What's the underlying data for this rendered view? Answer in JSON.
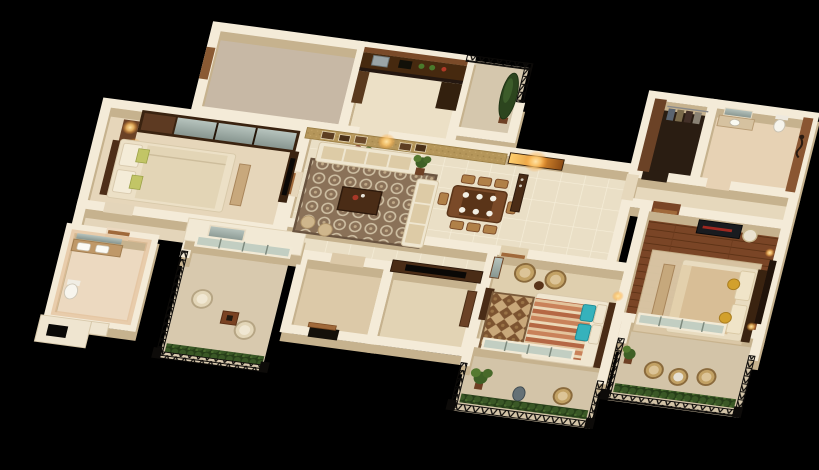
{
  "scene": {
    "title": "3D isometric floor plan render of a 3-bedroom apartment on a black background",
    "projection": "isometric 3D cutaway floor plan",
    "background_color": "#000000",
    "palette": {
      "wall_top": "#f4ebd8",
      "wall_side": "#c6b28e",
      "floor_tile": "#eadfc6",
      "accent_wall_gold": "#b5965a",
      "dark_wood": "#4a2c16",
      "mid_wood": "#8a5a33",
      "wood_floor": "#7a4526",
      "rug_brown": "#8a7158",
      "railing_iron": "#0d0b09",
      "plant_green": "#3f6026",
      "lamp_glow": "#ffd27f",
      "teal_pillow": "#36b2bc",
      "striped_bedding": "#c9825a",
      "bath_peach": "#e2bf98"
    },
    "rooms": [
      {
        "id": "store-room",
        "label": "Store / terrace room with bare taupe floor",
        "floor_color": "#c7b8a5",
        "furniture": []
      },
      {
        "id": "kitchen",
        "label": "Kitchen with dark wood cabinets and black countertop",
        "floor_color": "#ece0c6",
        "furniture": [
          "wall cabinets",
          "steel sink",
          "hob",
          "counter plants",
          "tall unit"
        ]
      },
      {
        "id": "service-balcony",
        "label": "Service balcony with iron railing and tall cypress plant",
        "floor_color": "#d5c7ad",
        "furniture": [
          "iron railing",
          "cypress plant"
        ]
      },
      {
        "id": "walk-in-closet",
        "label": "Walk-in closet with hanging clothes",
        "floor_color": "#2a1d12",
        "furniture": [
          "wood cabinet",
          "clothes rail"
        ]
      },
      {
        "id": "master-bathroom",
        "label": "Master bathroom with vanity, toilet and shower on brown wall",
        "floor_color": "#e7d2b4",
        "furniture": [
          "mirror",
          "vanity basin",
          "toilet",
          "shower fixture"
        ]
      },
      {
        "id": "suite-corridor",
        "label": "Corridor to master suite",
        "floor_color": "#e6d8bc",
        "furniture": []
      },
      {
        "id": "bedroom-1",
        "label": "Bedroom with mirrored wardrobe and lit bedside lamps",
        "floor_color": "#e6d6ba",
        "furniture": [
          "mirrored sliding wardrobe",
          "double bed with cream bedding",
          "green accent pillows",
          "corner dresser with lamps",
          "foot bench",
          "TV unit"
        ]
      },
      {
        "id": "inner-lobby",
        "label": "Inner lobby passage",
        "floor_color": "#e4d5ba",
        "furniture": []
      },
      {
        "id": "common-bathroom",
        "label": "Common bathroom with twin basin vanity and toilet",
        "floor_color": "#ecd9c0",
        "furniture": [
          "mirror",
          "twin basins",
          "toilet"
        ]
      },
      {
        "id": "living-room",
        "label": "Living room with gold accent wall, patterned rug and cream L-sofa",
        "floor_color": "#eadfc6",
        "furniture": [
          "gold textured accent wall with framed pictures and wall lamp",
          "patterned brown rug",
          "L-shaped cream sofa",
          "dark wood coffee table",
          "bonsai plant",
          "poufs"
        ]
      },
      {
        "id": "dining-area",
        "label": "Dining area with wooden table, chairs and place settings",
        "floor_color": "#eadfc6",
        "furniture": [
          "wood dining table",
          "eight chairs",
          "white plates",
          "sideboard",
          "lit wall niche",
          "potted plant"
        ]
      },
      {
        "id": "entrance-foyer",
        "label": "Entrance foyer with wooden door",
        "floor_color": "#dcc9a8",
        "furniture": [
          "open wooden door"
        ]
      },
      {
        "id": "study-room",
        "label": "Study room behind media wall with TV",
        "floor_color": "#e2d3b4",
        "furniture": [
          "media wall with TV",
          "wood cabinet"
        ]
      },
      {
        "id": "bedroom-2",
        "label": "Bedroom with orange striped bedding, teal pillows and wicker chairs",
        "floor_color": "#dfcfae",
        "furniture": [
          "bed with striped duvet",
          "teal pillows",
          "diamond rug",
          "two wicker chairs with round table",
          "dresser",
          "leaning mirror"
        ]
      },
      {
        "id": "master-bedroom",
        "label": "Master bedroom with wood plank floor and tan bed",
        "floor_color": "#7a4526",
        "furniture": [
          "double bed with tan duvet",
          "yellow cushions",
          "foot bench",
          "black console with red stripe",
          "white chair",
          "TV panel",
          "light rug"
        ]
      },
      {
        "id": "sitout-balcony",
        "label": "Sit-out balcony with wicker chairs and planter hedge",
        "floor_color": "#d8c9ae",
        "furniture": [
          "ornate iron railing",
          "two wicker chairs",
          "square wood table",
          "hedge planter"
        ]
      },
      {
        "id": "bedroom-2-balcony",
        "label": "Bedroom balcony with palm, vase and wicker chair",
        "floor_color": "#d3c4a8",
        "furniture": [
          "iron railing",
          "hedge planter",
          "palm plant",
          "grey vase",
          "wicker chair"
        ]
      },
      {
        "id": "master-balcony",
        "label": "Master balcony with round table and two wicker chairs",
        "floor_color": "#d3c4a8",
        "furniture": [
          "iron railing",
          "hedge planter",
          "round table",
          "two wicker chairs",
          "potted plant"
        ]
      }
    ]
  }
}
